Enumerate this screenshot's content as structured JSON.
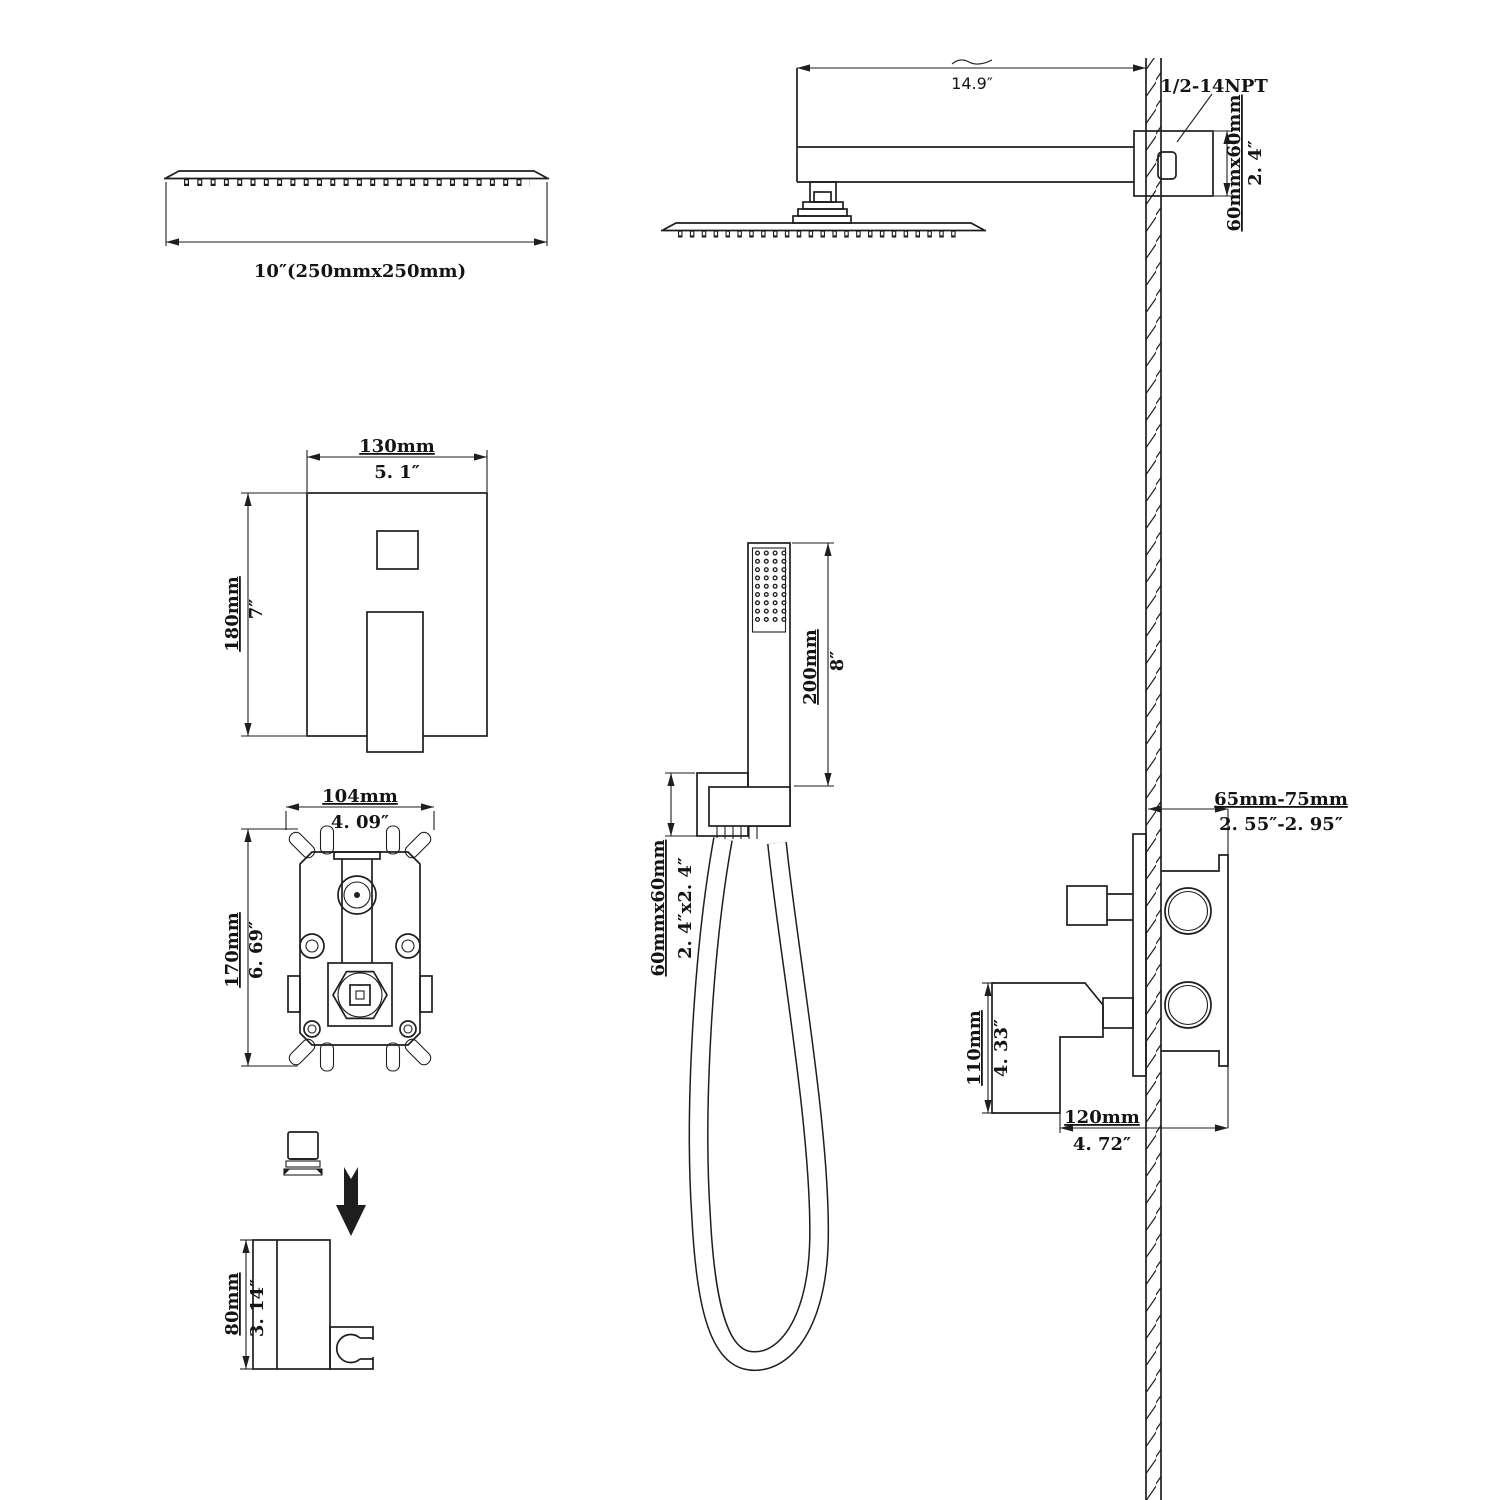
{
  "colors": {
    "background": "#ffffff",
    "line": "#1e1e1e"
  },
  "diagram": {
    "overhead_shower": {
      "size_label": "10″(250mmx250mm)"
    },
    "shower_arm": {
      "length": "14.9″",
      "thread_type": "1/2-14NPT",
      "flange_size_mm": "60mmx60mm",
      "flange_size_in": "2. 4″"
    },
    "trim_plate": {
      "width_mm": "130mm",
      "width_in": "5. 1″",
      "height_mm": "180mm",
      "height_in": "7″"
    },
    "rough_in_valve": {
      "width_mm": "104mm",
      "width_in": "4. 09″",
      "height_mm": "170mm",
      "height_in": "6. 69″"
    },
    "hand_shower": {
      "length_mm": "200mm",
      "length_in": "8″",
      "holder_size_mm": "60mmx60mm",
      "holder_size_in": "2. 4″x2. 4″"
    },
    "mixer_side_view": {
      "wall_depth_mm": "65mm-75mm",
      "wall_depth_in": "2. 55″-2. 95″",
      "handle_height_mm": "110mm",
      "handle_height_in": "4. 33″",
      "handle_depth_mm": "120mm",
      "handle_depth_in": "4. 72″"
    },
    "holder_bracket": {
      "height_mm": "80mm",
      "height_in": "3. 14″"
    }
  }
}
